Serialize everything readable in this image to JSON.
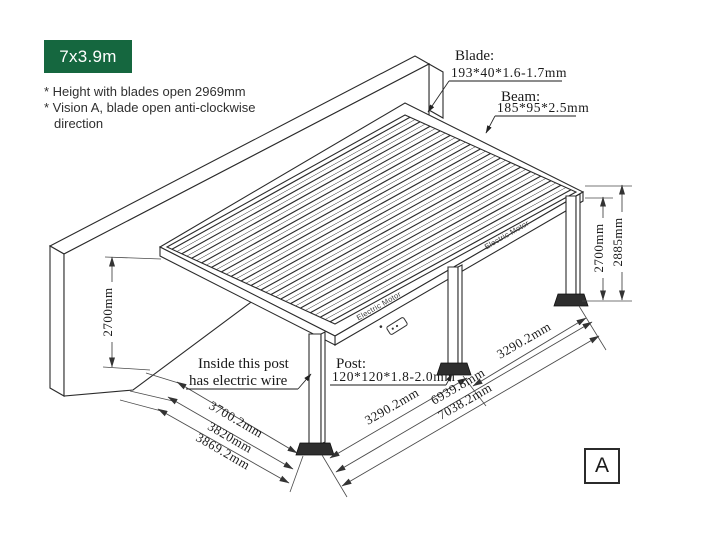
{
  "badge": {
    "label": "7x3.9m",
    "bg_color": "#15673F"
  },
  "notes": [
    "* Height with blades open 2969mm",
    "* Vision A, blade open anti-clockwise",
    "direction"
  ],
  "callouts": {
    "blade": {
      "title": "Blade:",
      "spec": "193*40*1.6-1.7mm"
    },
    "beam": {
      "title": "Beam:",
      "spec": "185*95*2.5mm"
    },
    "post": {
      "title": "Post:",
      "spec": "120*120*1.8-2.0mm"
    },
    "wire": {
      "line1": "Inside this post",
      "line2": "has electric wire"
    }
  },
  "dimensions": {
    "wall_height": "2700mm",
    "post_height": "2700mm",
    "total_height": "2885mm",
    "depth_inner": "3700.2mm",
    "depth_mid": "3820mm",
    "depth_outer": "3869.2mm",
    "bay_left": "3290.2mm",
    "bay_right": "3290.2mm",
    "width_inner": "6939.8mm",
    "width_outer": "7038.2mm"
  },
  "labels": {
    "motor_front_left": "Electric Motor",
    "motor_front_right": "Electric Motor"
  },
  "view_marker": "A",
  "colors": {
    "line": "#2b2b2b",
    "dim_line": "#4a4a4a",
    "badge_bg": "#15673F",
    "text": "#1a1a1a"
  }
}
